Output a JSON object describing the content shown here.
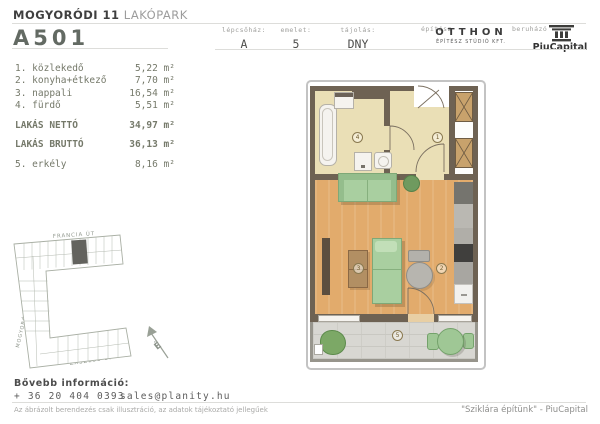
{
  "header": {
    "project_bold": "MOGYORÓDI 11",
    "project_light": " LAKÓPARK",
    "unit_id": "A501",
    "meta": [
      {
        "label": "lépcsőház:",
        "value": "A"
      },
      {
        "label": "emelet:",
        "value": "5"
      },
      {
        "label": "tájolás:",
        "value": "DNY"
      }
    ],
    "architect_label": "építész",
    "architect_name": "OTTHON",
    "architect_sub": "ÉPÍTÉSZ STÚDIÓ KFT.",
    "developer_label": "beruházó",
    "developer_name": "PiuCapital"
  },
  "rooms": [
    {
      "label": "1. közlekedő",
      "area": "5,22 m²"
    },
    {
      "label": "2. konyha+étkező",
      "area": "7,70 m²"
    },
    {
      "label": "3. nappali",
      "area": "16,54 m²"
    },
    {
      "label": "4. fürdő",
      "area": "5,51 m²"
    }
  ],
  "totals": [
    {
      "label": "LAKÁS NETTÓ",
      "area": "34,97 m²"
    },
    {
      "label": "LAKÁS BRUTTÓ",
      "area": "36,13 m²"
    }
  ],
  "extra_room": {
    "label": "5. erkély",
    "area": "8,16 m²"
  },
  "plan": {
    "labels": [
      "1",
      "2",
      "3",
      "4",
      "5"
    ]
  },
  "site_plan": {
    "street_top": "FRANCIA ÚT",
    "street_left": "MOGYORÓDI ÚT",
    "street_bottom": "ZÁSZLÓS U.",
    "north_label": "É"
  },
  "footer": {
    "info_title": "Bővebb információ:",
    "phone": "+ 36 20 404 0393",
    "email": "sales@planity.hu",
    "disclaimer": "Az ábrázolt berendezés csak illusztráció, az adatok tájékoztató jellegűek",
    "slogan": "\"Sziklára építünk\" - PiuCapital"
  },
  "colors": {
    "wall": "#6e6253",
    "wood_floor": "#e2ab6c",
    "tile_floor": "#eadfb6",
    "balcony_floor": "#d8d7d2",
    "furniture_green": "#a9cfa0",
    "accent_text": "#636a63"
  }
}
